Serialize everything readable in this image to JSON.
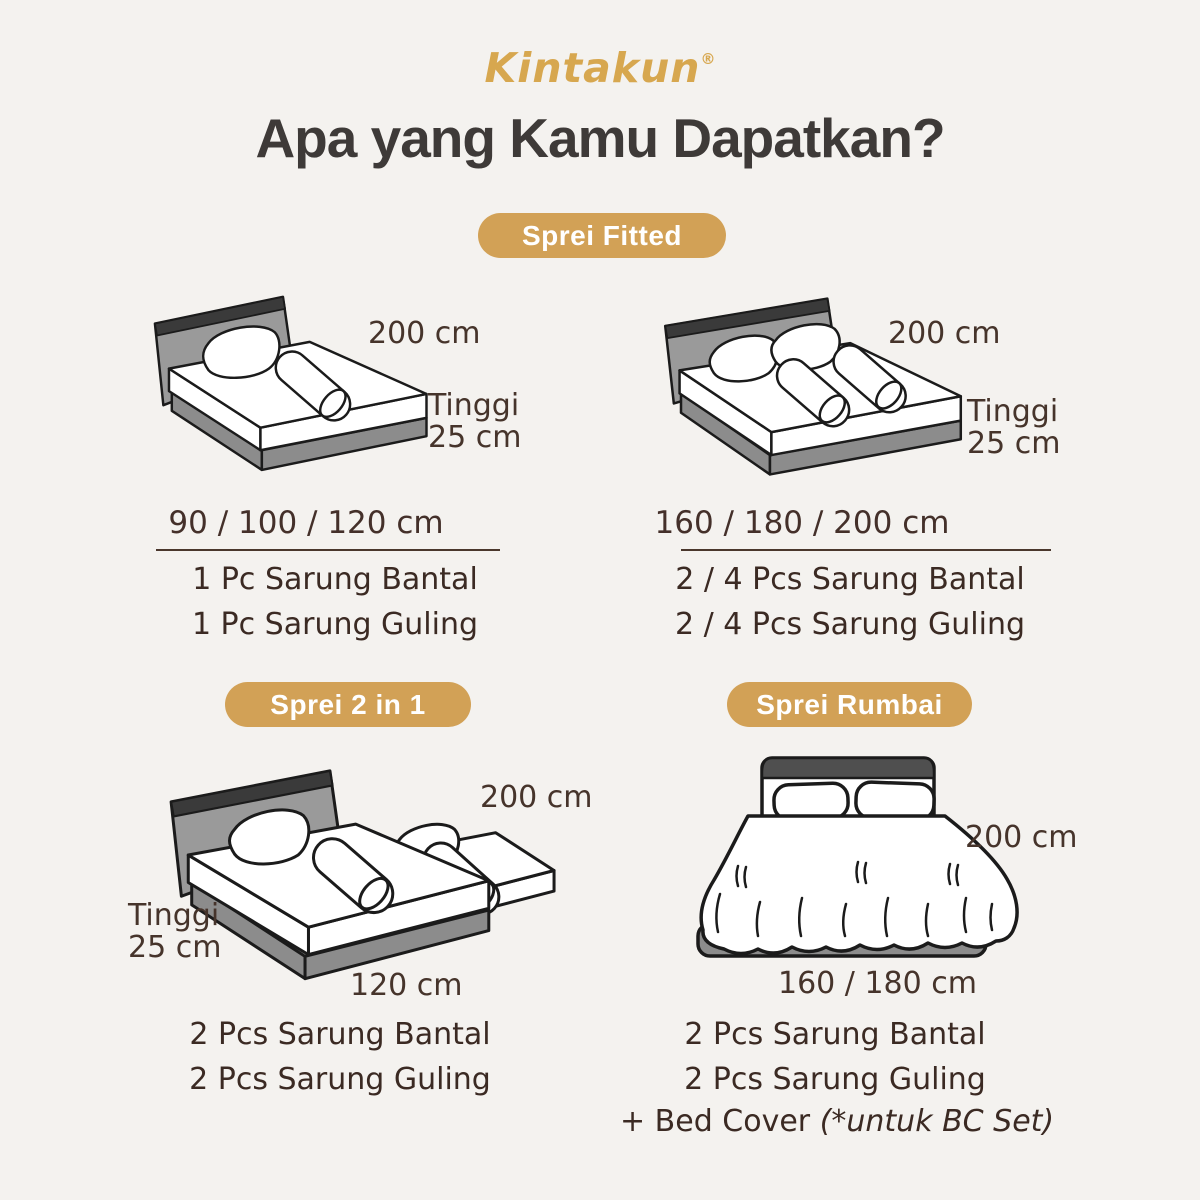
{
  "brand": {
    "logo_text": "Kintakun",
    "registered_mark": "®"
  },
  "title": "Apa yang Kamu Dapatkan?",
  "colors": {
    "background": "#F4F2EF",
    "gold_badge": "#D2A156",
    "gold_logo": "#D7A74F",
    "brown_text": "#44302A",
    "heading_text": "#3E3A38",
    "headboard_gray": "#9A9A9A",
    "base_gray": "#8C8C8C",
    "outline": "#1B1B1B"
  },
  "sections": {
    "fitted": {
      "badge_label": "Sprei Fitted",
      "single": {
        "width_label": "200 cm",
        "height_label_line1": "Tinggi",
        "height_label_line2": "25 cm",
        "size_options": "90 / 100 / 120 cm",
        "items": [
          "1 Pc Sarung Bantal",
          "1 Pc Sarung Guling"
        ]
      },
      "double": {
        "width_label": "200 cm",
        "height_label_line1": "Tinggi",
        "height_label_line2": "25 cm",
        "size_options": "160 / 180 / 200 cm",
        "items": [
          "2 / 4 Pcs Sarung Bantal",
          "2 / 4 Pcs Sarung Guling"
        ]
      }
    },
    "two_in_one": {
      "badge_label": "Sprei 2 in 1",
      "width_label": "200 cm",
      "height_label_line1": "Tinggi",
      "height_label_line2": "25 cm",
      "bottom_width_label": "120 cm",
      "items": [
        "2 Pcs Sarung Bantal",
        "2 Pcs Sarung Guling"
      ]
    },
    "rumbai": {
      "badge_label": "Sprei Rumbai",
      "width_label": "200 cm",
      "bottom_width_label": "160 / 180 cm",
      "items": [
        "2 Pcs Sarung Bantal",
        "2 Pcs Sarung Guling"
      ],
      "bonus_item_text": "+ Bed Cover ",
      "bonus_item_note": "(*untuk BC Set)"
    }
  }
}
